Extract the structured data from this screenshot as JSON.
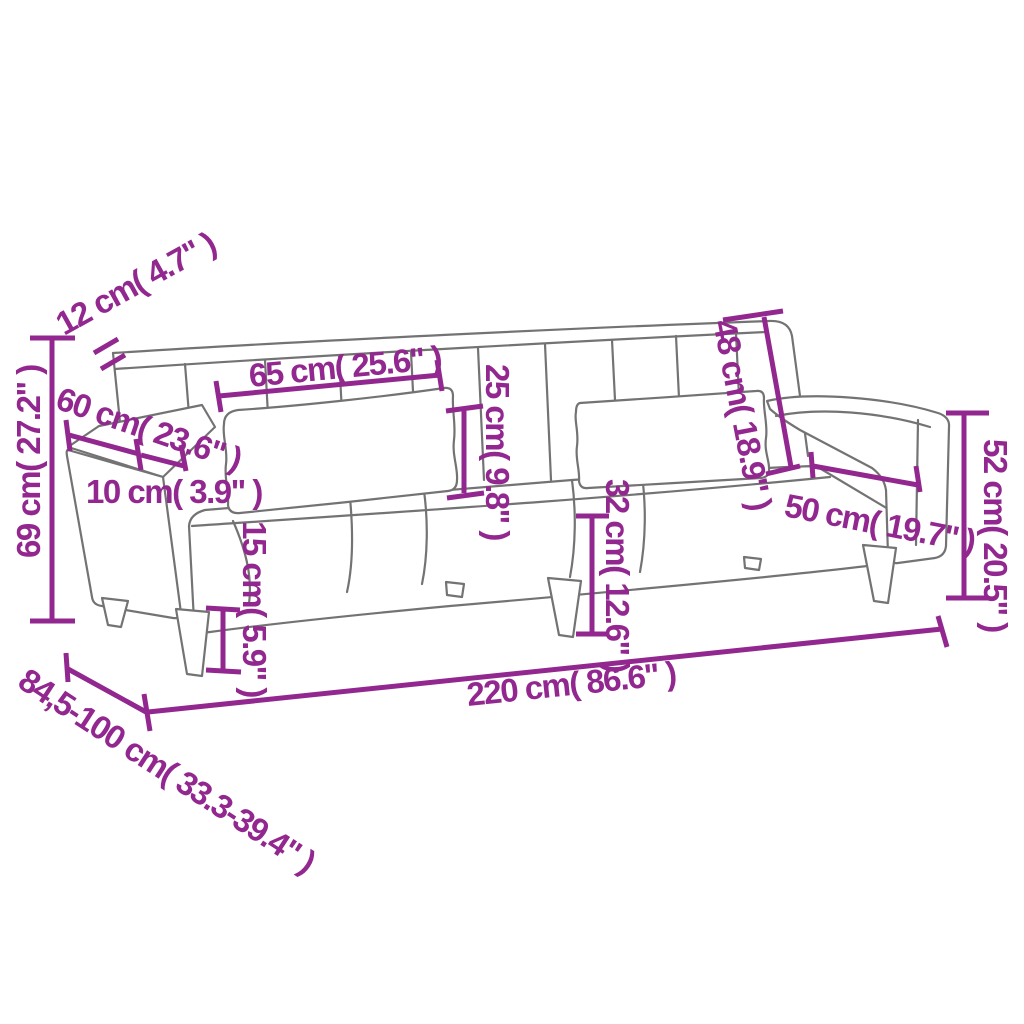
{
  "colors": {
    "dimension_accent": "#92278f",
    "sofa_outline": "#737373",
    "background": "#ffffff"
  },
  "diagram": {
    "kind": "product-dimension-diagram",
    "subject": "sofa-bed-with-armrests-and-two-pillows",
    "unit_system": "cm with inch conversion",
    "dimensions": {
      "backrest_thickness": "12 cm( 4.7\" )",
      "armrest_length": "60 cm( 23.6\" )",
      "armrest_width": "10 cm( 3.9\" )",
      "pillow_width": "65 cm( 25.6\" )",
      "pillow_height": "25 cm( 9.8\" )",
      "backrest_height": "48 cm( 18.9\" )",
      "seat_depth": "50 cm( 19.7\" )",
      "side_height": "52 cm( 20.5\" )",
      "total_height": "69 cm( 27.2\" )",
      "seat_height": "32 cm( 12.6\" )",
      "leg_height": "15 cm( 5.9\" )",
      "total_width": "220 cm( 86.6\" )",
      "total_depth": "84,5-100 cm( 33.3-39.4\" )"
    }
  }
}
